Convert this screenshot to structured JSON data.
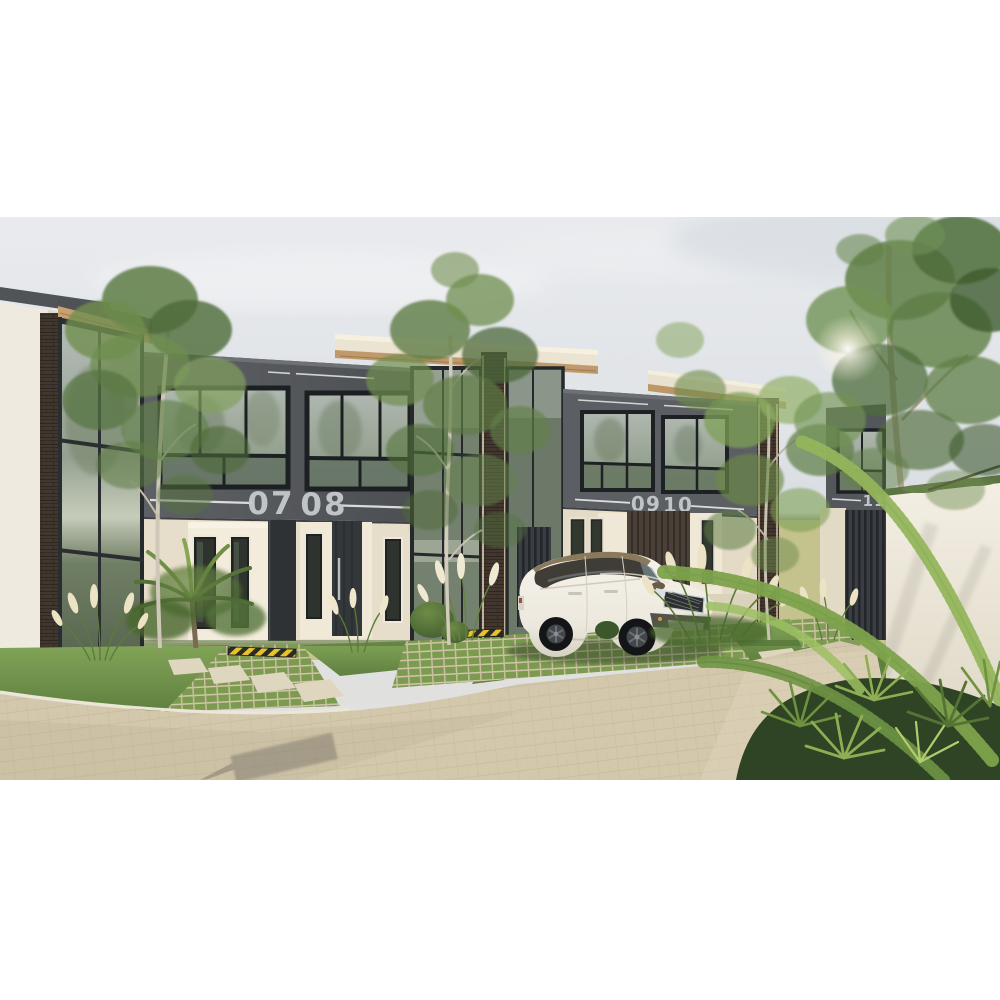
{
  "scene": {
    "description": "architectural exterior render of modern two-storey townhouse row with parked white SUV",
    "units": [
      {
        "number": "07"
      },
      {
        "number": "08"
      },
      {
        "number": "09"
      },
      {
        "number": "10"
      },
      {
        "number": "11"
      }
    ],
    "colors": {
      "sky": "#e3e6ea",
      "facade_dark": "#55585c",
      "facade_cream": "#e6ddca",
      "wood_soffit": "#c49b6e",
      "brick": "#42372e",
      "lawn": "#769a4e",
      "road_paver": "#d3c7ac",
      "perimeter_wall": "#f0ece1",
      "car_body": "#f2efe7",
      "car_roof": "#8b795d",
      "unit_number_text": "#c7cacc",
      "accent_line": "#e9eaea",
      "led_strip": "#ffd9a2",
      "safety_yellow": "#e8c22a",
      "safety_black": "#2b2b28"
    }
  }
}
